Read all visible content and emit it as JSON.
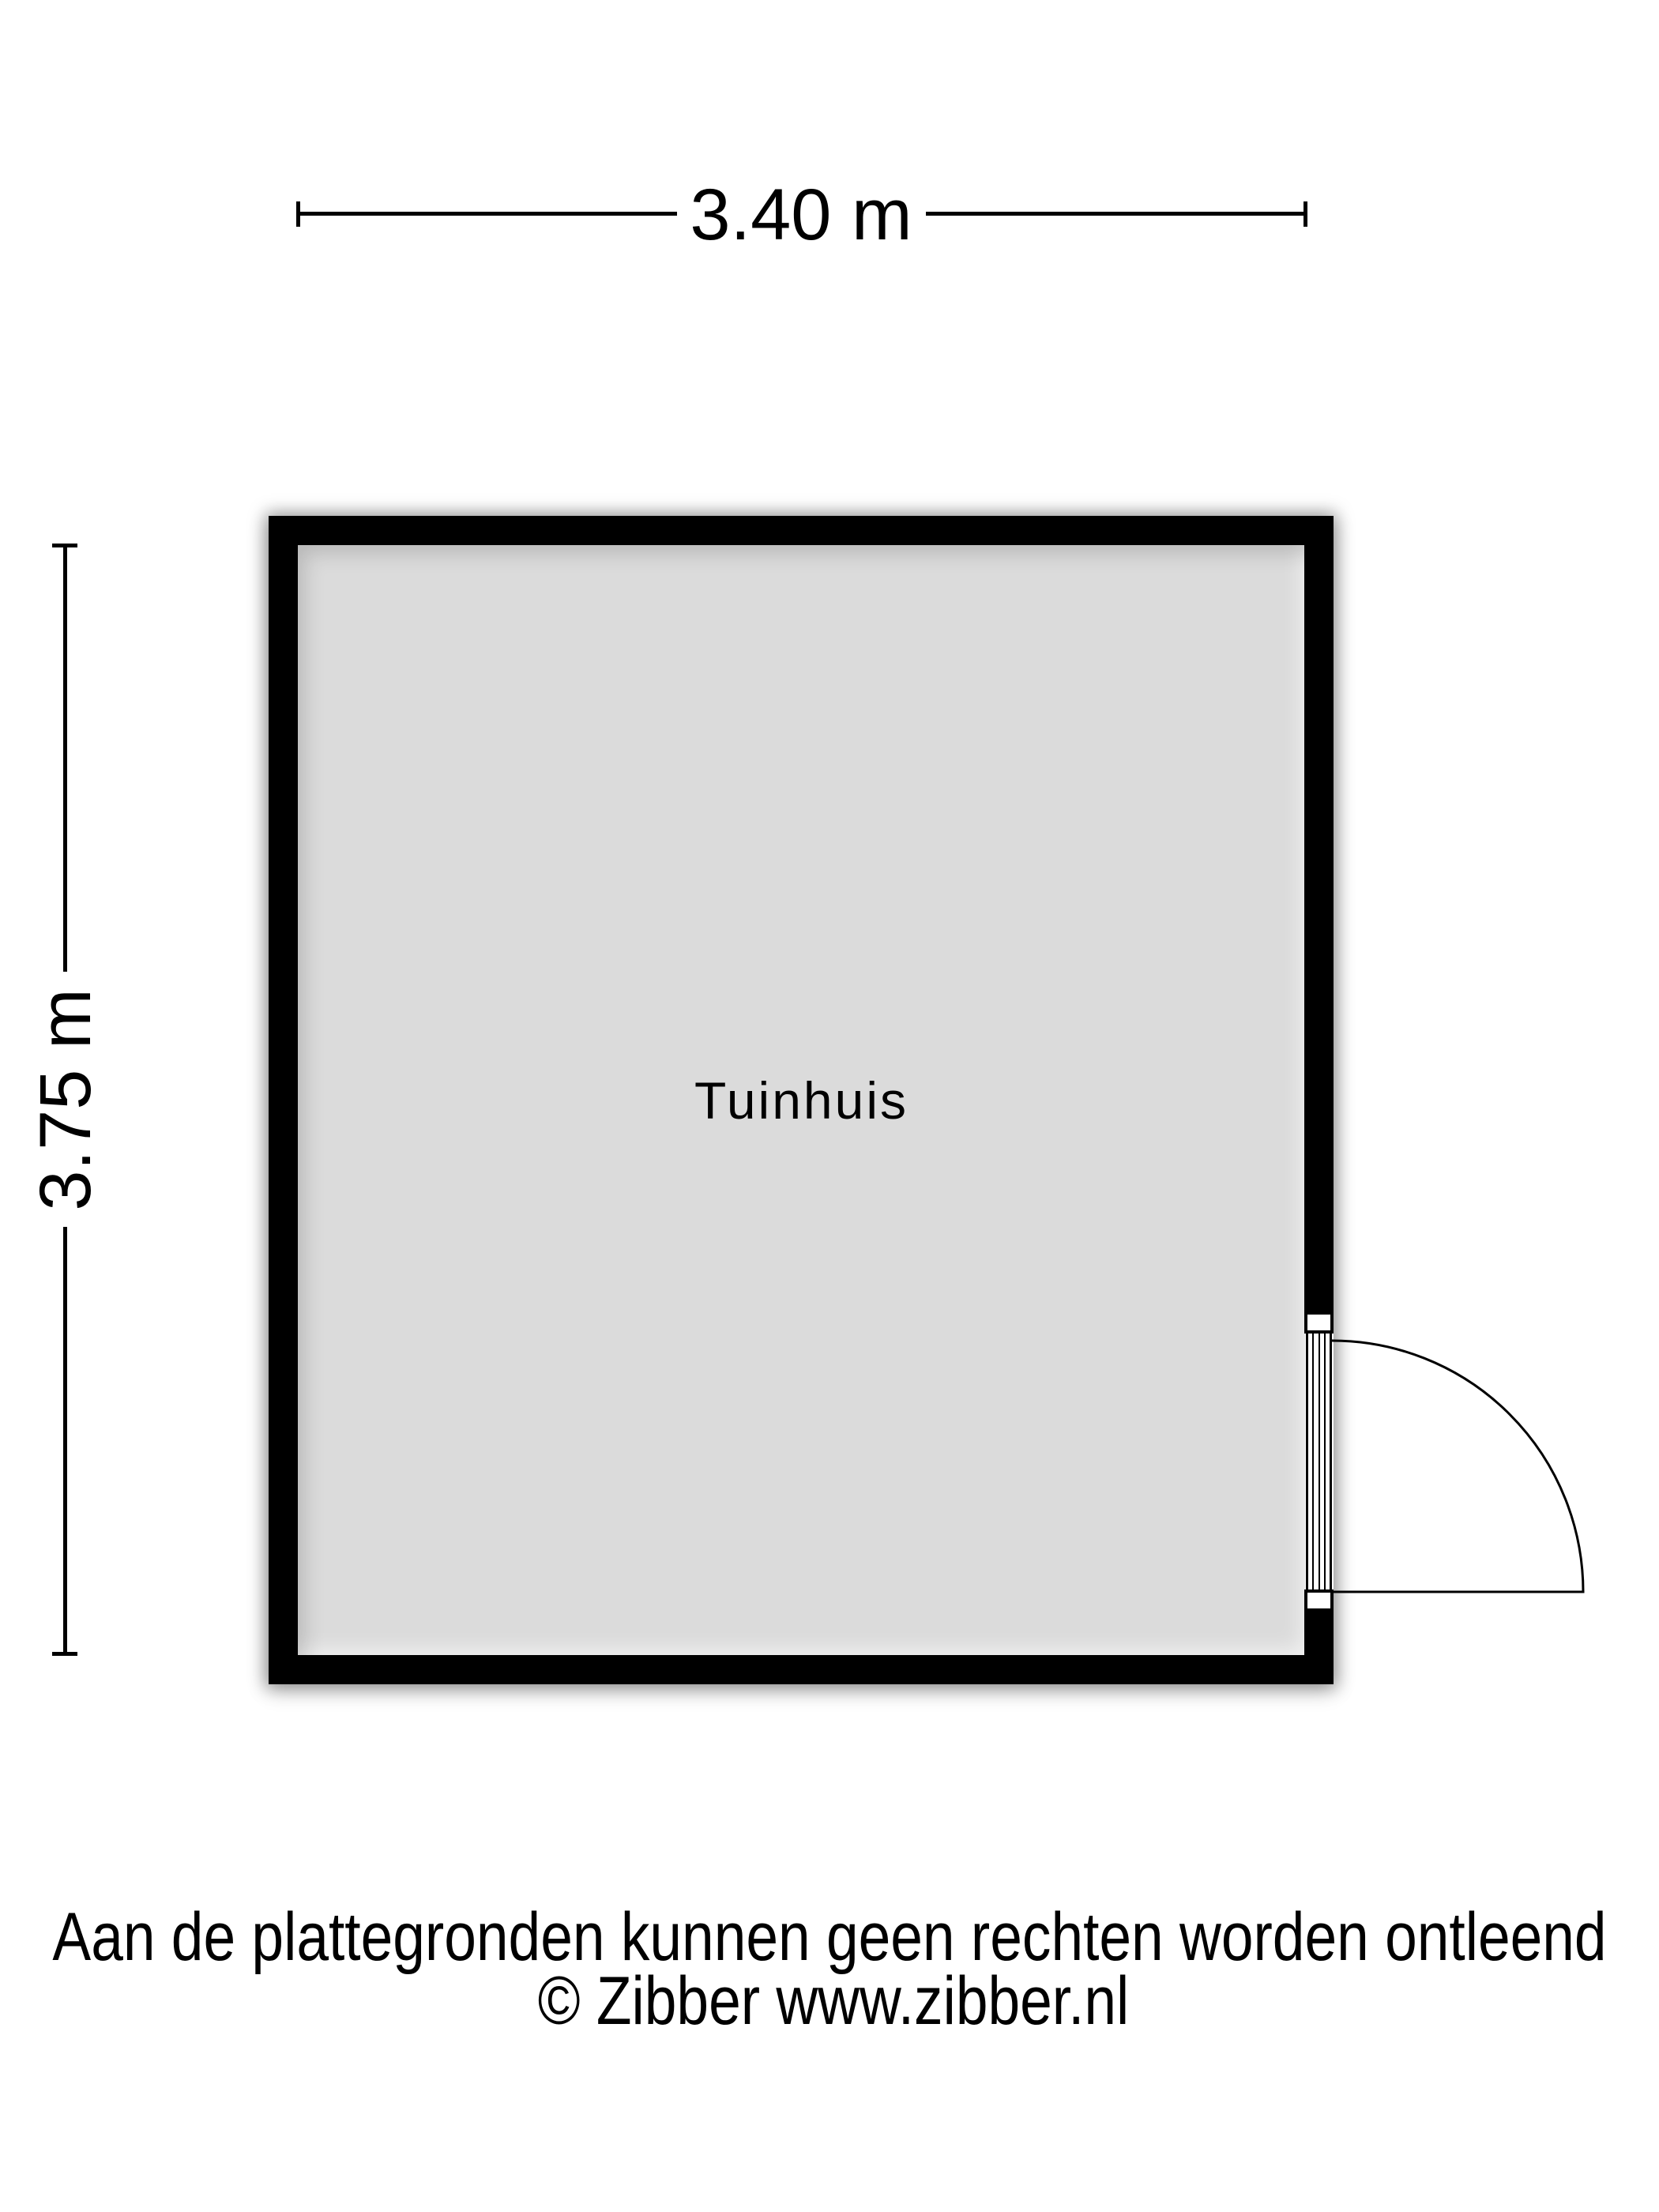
{
  "floorplan": {
    "room": {
      "label": "Tuinhuis"
    },
    "dimensions": {
      "width_label": "3.40 m",
      "height_label": "3.75 m"
    },
    "colors": {
      "wall": "#000000",
      "floor": "#dbdbdb",
      "background": "#ffffff",
      "line": "#000000"
    }
  },
  "footer": {
    "disclaimer": "Aan de plattegronden kunnen geen rechten worden ontleend",
    "copyright": "© Zibber www.zibber.nl"
  }
}
